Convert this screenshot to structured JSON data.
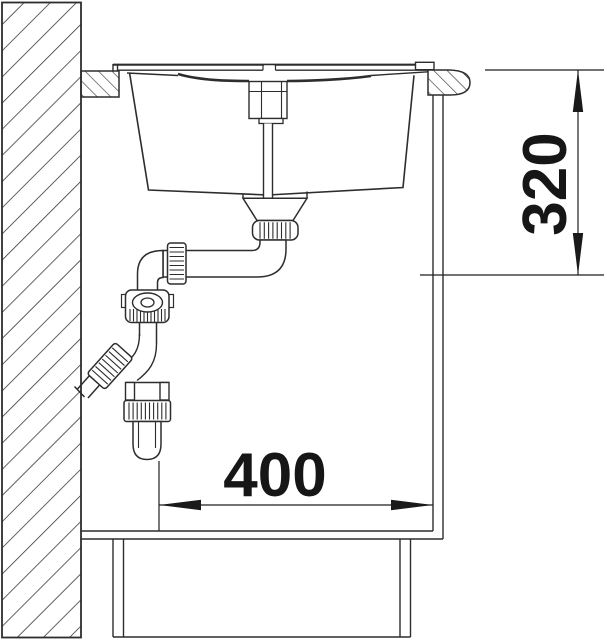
{
  "drawing_type": "sink-cabinet-installation-section",
  "dimensions": {
    "depth": "320",
    "width": "400"
  },
  "colors": {
    "line": "#2d2d2d",
    "dimension_line": "#1f1f1f",
    "text": "#161616",
    "background": "#ffffff"
  },
  "components": [
    "wall-section",
    "worktop",
    "sink-rim",
    "sink-bowl",
    "drain-remote-control",
    "waste-outlet",
    "drain-pipe",
    "siphon-trap",
    "wall-drain-connection",
    "cabinet-front-panel",
    "cabinet-floor",
    "plinth",
    "dimension-depth",
    "dimension-width"
  ]
}
